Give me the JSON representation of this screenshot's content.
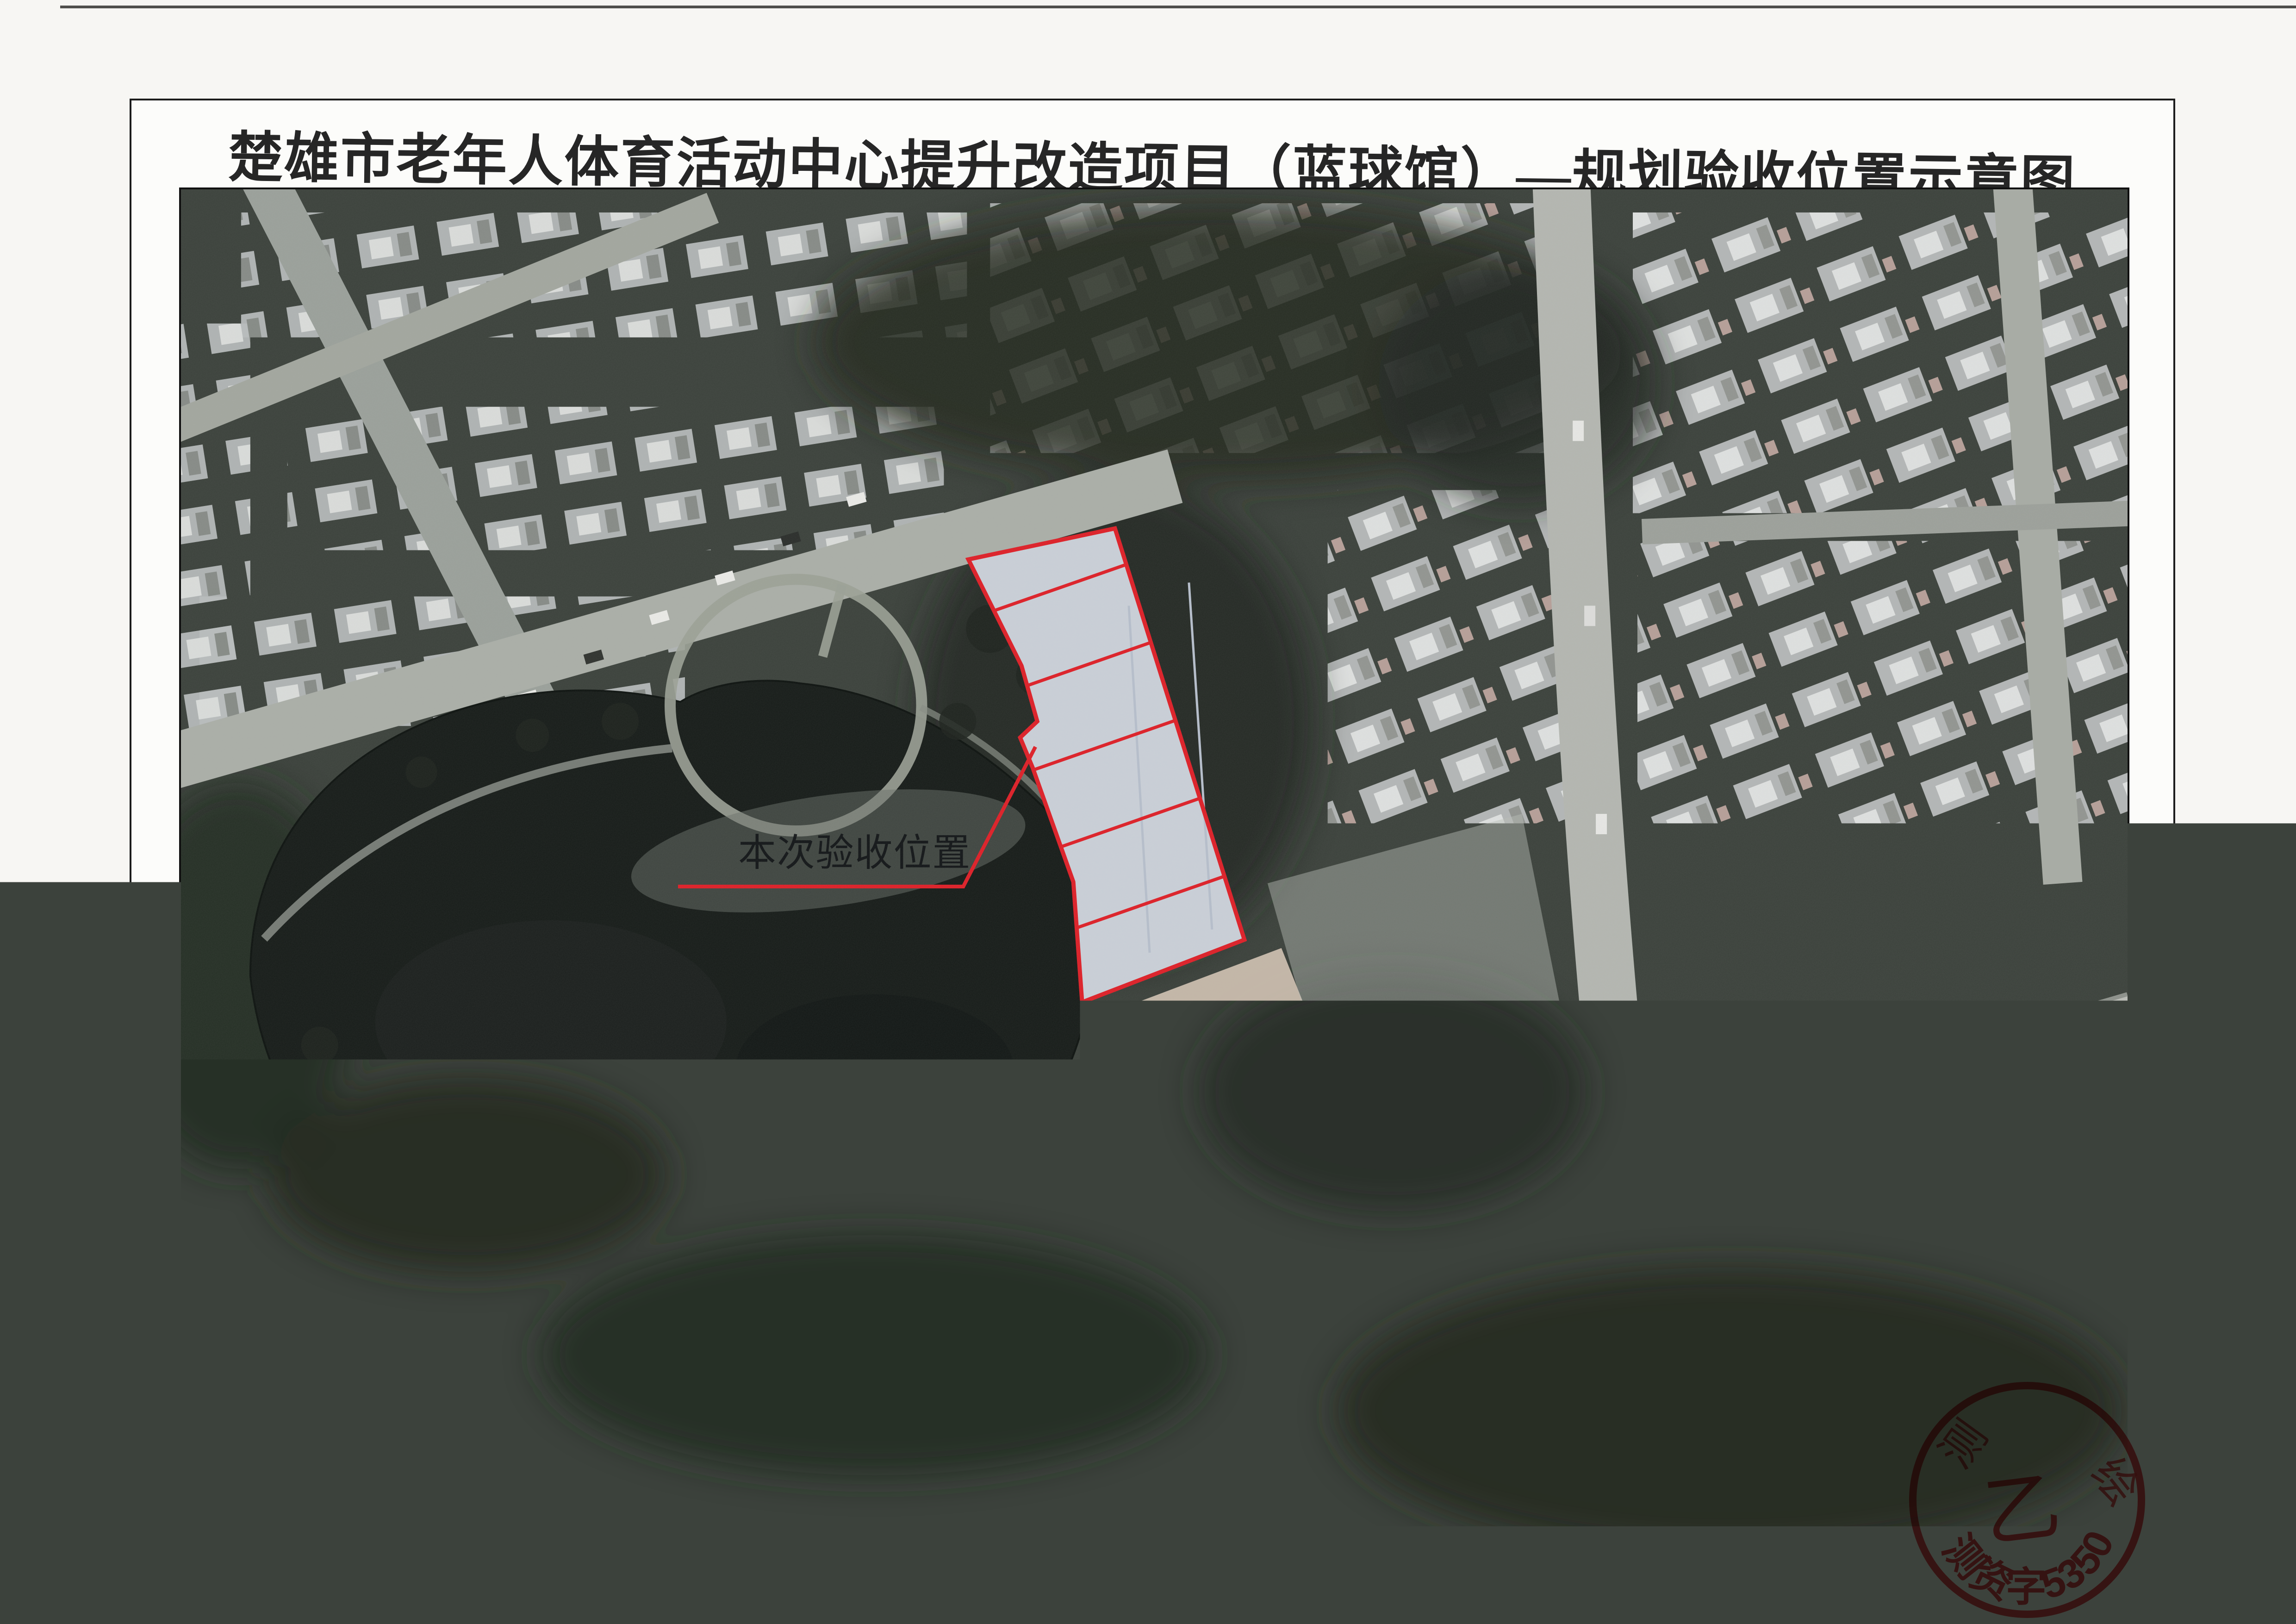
{
  "page": {
    "title": "楚雄市老年人体育活动中心提升改造项目（蓝球馆）—规划验收位置示意图"
  },
  "map_annotations": {
    "site_label": "本次验收位置",
    "road_label": "阳光大道",
    "poi_label": "源生大药房",
    "poi_icon": "mortar-pestle-pin-icon"
  },
  "stamp": {
    "center_grade": "乙",
    "serial": "测资字53506060",
    "ring_partial": [
      "测",
      "绘"
    ]
  },
  "colors": {
    "annotation-red": "#dd2028",
    "stamp-red": "#e03a3a",
    "site-roof": "#c9cfd7",
    "paper": "#fcfcfa",
    "road-light": "#b7bab4",
    "lake-dark": "#171c19",
    "sand": "#d8cec1"
  }
}
